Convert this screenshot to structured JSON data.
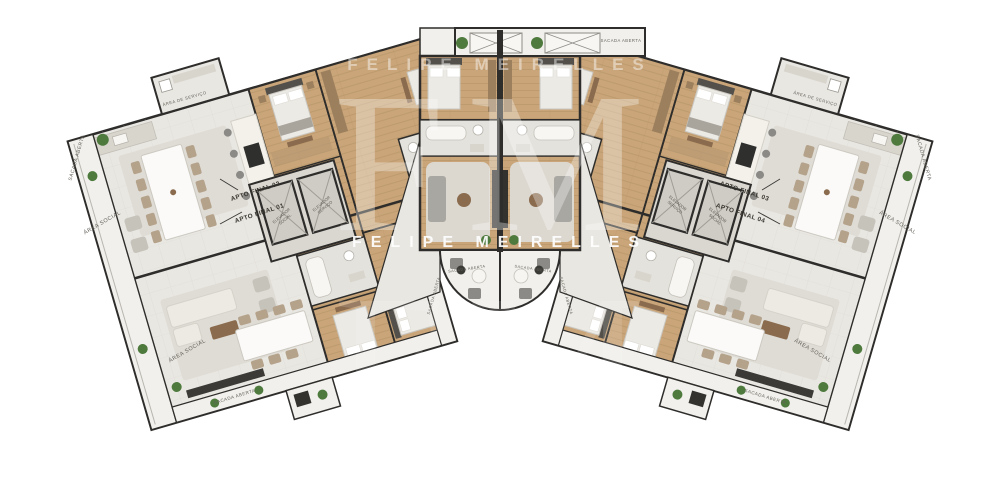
{
  "plan": {
    "watermark": {
      "initials": "FM",
      "name": "FELIPE MEIRELLES"
    },
    "units": {
      "u02": "APTO FINAL 02",
      "u01": "APTO FINAL 01",
      "u03": "APTO FINAL 03",
      "u04": "APTO FINAL 04"
    },
    "rooms": {
      "area_social": "ÁREA SOCIAL",
      "sacada_aberta": "SACADA ABERTA",
      "area_servico": "ÁREA DE SERVIÇO",
      "elevador": "ELEVADOR",
      "elevador_social": "SOCIAL",
      "elevador_servico": "SERVIÇO"
    },
    "colors": {
      "background": "#ffffff",
      "floor": "#e9e7e2",
      "balcony": "#f1f0ec",
      "wood": "#c9a579",
      "wall": "#2e2d2b",
      "marble": "#f3f1ea",
      "dark_furniture": "#3a3936",
      "plant": "#4e7a3e",
      "watermark": "#ffffff"
    }
  }
}
